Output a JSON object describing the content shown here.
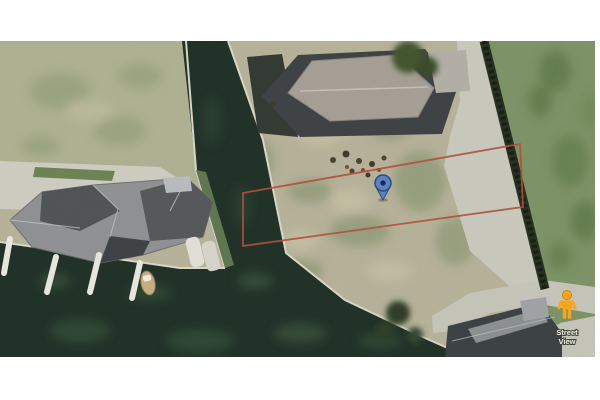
{
  "street_view": {
    "line1": "Street",
    "line2": "View"
  },
  "icons": {
    "marker": "location-pin-icon",
    "pegman": "street-view-pegman-icon"
  },
  "colors": {
    "boundary_red": "#b0503c",
    "marker_blue": "#5b82c6",
    "marker_border": "#2c4a7c",
    "marker_dot": "#16294d",
    "pegman_orange": "#f9a61a",
    "water": "#203127",
    "lot_ground": "#b7b29a",
    "lawn": "#aeb192",
    "grass_right": "#7d9366",
    "road": "#cac9bd",
    "hedge": "#27301f"
  }
}
